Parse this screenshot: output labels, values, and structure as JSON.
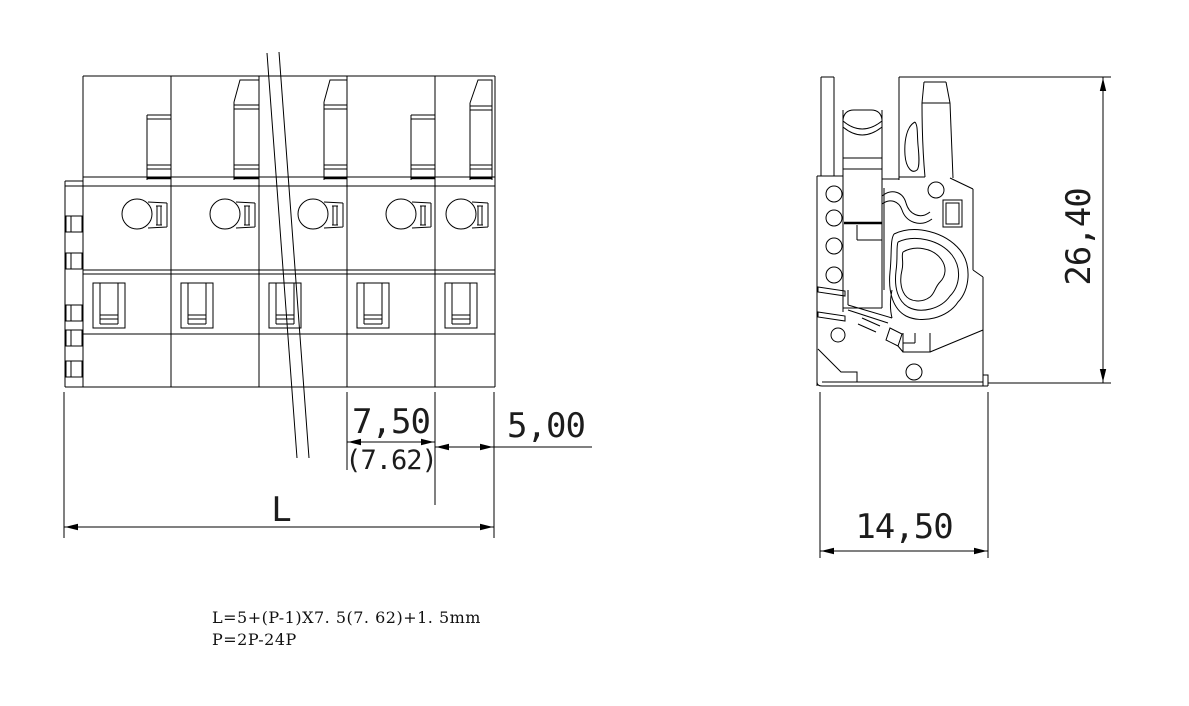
{
  "colors": {
    "line": "#000000",
    "background": "#ffffff"
  },
  "front_view": {
    "dimensions": {
      "pitch": "7,50",
      "pitch_alt": "(7.62)",
      "end_width": "5,00",
      "total_length": "L"
    }
  },
  "side_view": {
    "dimensions": {
      "height": "26,40",
      "depth": "14,50"
    }
  },
  "notes": {
    "length_formula": "L=5+(P-1)X7. 5(7. 62)+1. 5mm",
    "poles_range": "P=2P-24P"
  }
}
